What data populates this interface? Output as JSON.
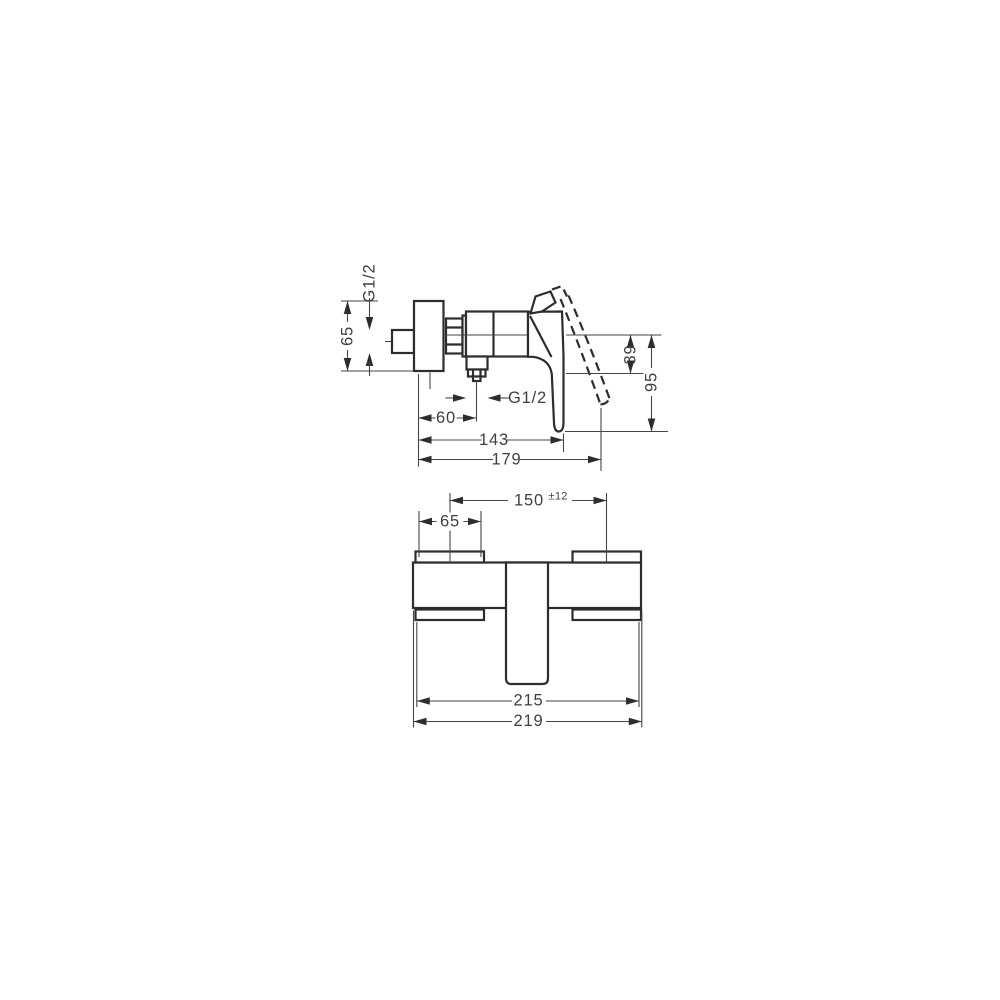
{
  "document": {
    "background_color": "#ffffff",
    "part_line_color": "#2d2d2d",
    "dimension_color": "#3f3f3f"
  },
  "side_view": {
    "inlet_thread": "G1/2",
    "escutcheon_height": "65",
    "outlet_drop": "39",
    "handle_drop": "95",
    "outlet_offset": "60",
    "outlet_thread": "G1/2",
    "handle_reach": "143",
    "overall_depth": "179"
  },
  "front_view": {
    "connection_spacing": "150",
    "connection_tolerance": "±12",
    "escutcheon_width": "65",
    "body_width": "215",
    "overall_width": "219"
  }
}
